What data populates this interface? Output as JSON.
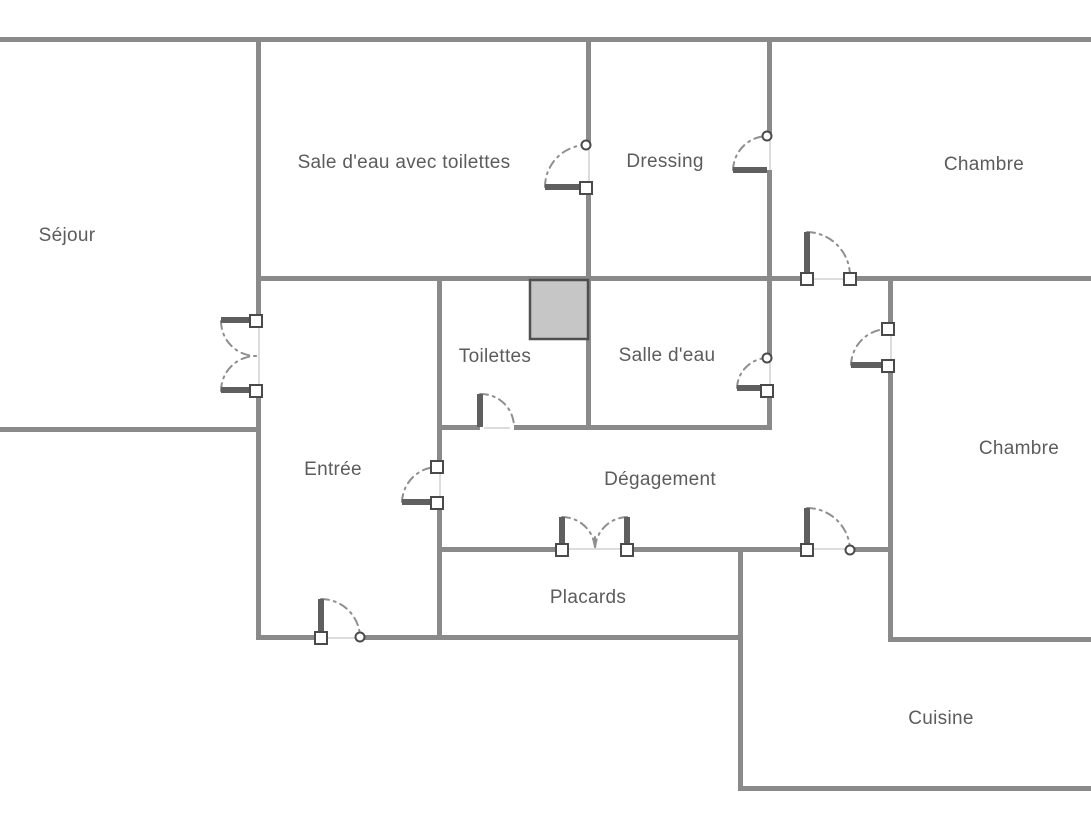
{
  "canvas": {
    "width": 1091,
    "height": 818,
    "background": "#ffffff"
  },
  "colors": {
    "wall": "#8a8a8a",
    "door_leaf": "#5f5f5f",
    "swing_arc": "#8f8f8f",
    "opening_line": "#dcdcdc",
    "hinge_stroke": "#4a4a4a",
    "hinge_fill": "#ffffff",
    "shaft_fill": "#c6c6c6",
    "shaft_stroke": "#4f4f4f",
    "label_text": "#5c5c5c"
  },
  "rooms": [
    {
      "id": "sejour",
      "label": "Séjour",
      "cx": 67,
      "cy": 236
    },
    {
      "id": "sale-deau-avec-toilettes",
      "label": "Sale d'eau avec toilettes",
      "cx": 404,
      "cy": 163
    },
    {
      "id": "dressing",
      "label": "Dressing",
      "cx": 665,
      "cy": 162
    },
    {
      "id": "chambre-haut",
      "label": "Chambre",
      "cx": 984,
      "cy": 165
    },
    {
      "id": "toilettes",
      "label": "Toilettes",
      "cx": 495,
      "cy": 357
    },
    {
      "id": "salle-deau",
      "label": "Salle d'eau",
      "cx": 667,
      "cy": 356
    },
    {
      "id": "entree",
      "label": "Entrée",
      "cx": 333,
      "cy": 470
    },
    {
      "id": "degagement",
      "label": "Dégagement",
      "cx": 660,
      "cy": 480
    },
    {
      "id": "chambre-droite",
      "label": "Chambre",
      "cx": 1019,
      "cy": 449
    },
    {
      "id": "placards",
      "label": "Placards",
      "cx": 588,
      "cy": 598
    },
    {
      "id": "cuisine",
      "label": "Cuisine",
      "cx": 941,
      "cy": 719
    }
  ],
  "shaft": {
    "x": 530,
    "y": 280,
    "w": 58,
    "h": 59
  },
  "walls": [
    [
      0,
      37,
      1091,
      5
    ],
    [
      0,
      427,
      259,
      5
    ],
    [
      256,
      276,
      549,
      5
    ],
    [
      850,
      276,
      241,
      5
    ],
    [
      437,
      425,
      43,
      5
    ],
    [
      514,
      425,
      256,
      5
    ],
    [
      437,
      547,
      125,
      5
    ],
    [
      628,
      547,
      179,
      5
    ],
    [
      850,
      547,
      42,
      5
    ],
    [
      256,
      635,
      65,
      5
    ],
    [
      360,
      635,
      380,
      5
    ],
    [
      888,
      637,
      203,
      5
    ],
    [
      738,
      786,
      353,
      5
    ],
    [
      256,
      37,
      5,
      290
    ],
    [
      256,
      385,
      5,
      255
    ],
    [
      586,
      37,
      5,
      110
    ],
    [
      586,
      186,
      5,
      244
    ],
    [
      767,
      37,
      5,
      100
    ],
    [
      767,
      170,
      5,
      190
    ],
    [
      767,
      388,
      5,
      42
    ],
    [
      437,
      278,
      5,
      189
    ],
    [
      437,
      501,
      5,
      139
    ],
    [
      888,
      278,
      5,
      53
    ],
    [
      888,
      364,
      5,
      276
    ],
    [
      738,
      549,
      5,
      242
    ]
  ],
  "door_openings": [
    [
      258,
      327,
      2,
      58
    ],
    [
      588,
      150,
      2,
      36
    ],
    [
      769,
      140,
      2,
      30
    ],
    [
      812,
      278,
      33,
      2
    ],
    [
      890,
      334,
      2,
      30
    ],
    [
      769,
      362,
      2,
      26
    ],
    [
      484,
      427,
      26,
      2
    ],
    [
      439,
      472,
      2,
      29
    ],
    [
      568,
      548,
      55,
      2
    ],
    [
      812,
      548,
      33,
      2
    ],
    [
      326,
      637,
      29,
      2
    ]
  ],
  "door_leaves": [
    [
      221,
      317,
      32,
      6
    ],
    [
      221,
      387,
      32,
      6
    ],
    [
      545,
      184,
      41,
      6
    ],
    [
      733,
      167,
      34,
      6
    ],
    [
      804,
      232,
      6,
      45
    ],
    [
      851,
      362,
      37,
      6
    ],
    [
      737,
      385,
      30,
      6
    ],
    [
      477,
      394,
      6,
      33
    ],
    [
      402,
      499,
      35,
      6
    ],
    [
      559,
      517,
      6,
      31
    ],
    [
      624,
      517,
      6,
      31
    ],
    [
      804,
      508,
      6,
      41
    ],
    [
      318,
      599,
      6,
      38
    ]
  ],
  "swing_arcs": [
    "M221,321 A35,35 0 0 0 256,356",
    "M221,391 A35,35 0 0 1 256,356",
    "M545,187 A42,42 0 0 1 586,145",
    "M733,170 A35,35 0 0 1 767,136",
    "M807,232 A44,44 0 0 1 850,276",
    "M851,365 A37,37 0 0 1 888,329",
    "M737,388 A31,31 0 0 1 767,358",
    "M480,394 A33,33 0 0 1 514,427",
    "M402,502 A36,36 0 0 1 437,467",
    "M562,517 A33,33 0 0 1 595,549",
    "M627,517 A33,33 0 0 0 595,549",
    "M595,537 L595,549",
    "M807,508 A43,43 0 0 1 850,550",
    "M321,599 A39,39 0 0 1 360,637"
  ],
  "hinge_squares": [
    [
      256,
      321
    ],
    [
      256,
      391
    ],
    [
      586,
      188
    ],
    [
      807,
      279
    ],
    [
      850,
      279
    ],
    [
      888,
      329
    ],
    [
      888,
      366
    ],
    [
      767,
      391
    ],
    [
      437,
      467
    ],
    [
      437,
      503
    ],
    [
      562,
      550
    ],
    [
      627,
      550
    ],
    [
      807,
      550
    ],
    [
      321,
      638
    ]
  ],
  "hinge_rings": [
    [
      586,
      145
    ],
    [
      767,
      136
    ],
    [
      767,
      358
    ],
    [
      850,
      550
    ],
    [
      360,
      637
    ]
  ]
}
